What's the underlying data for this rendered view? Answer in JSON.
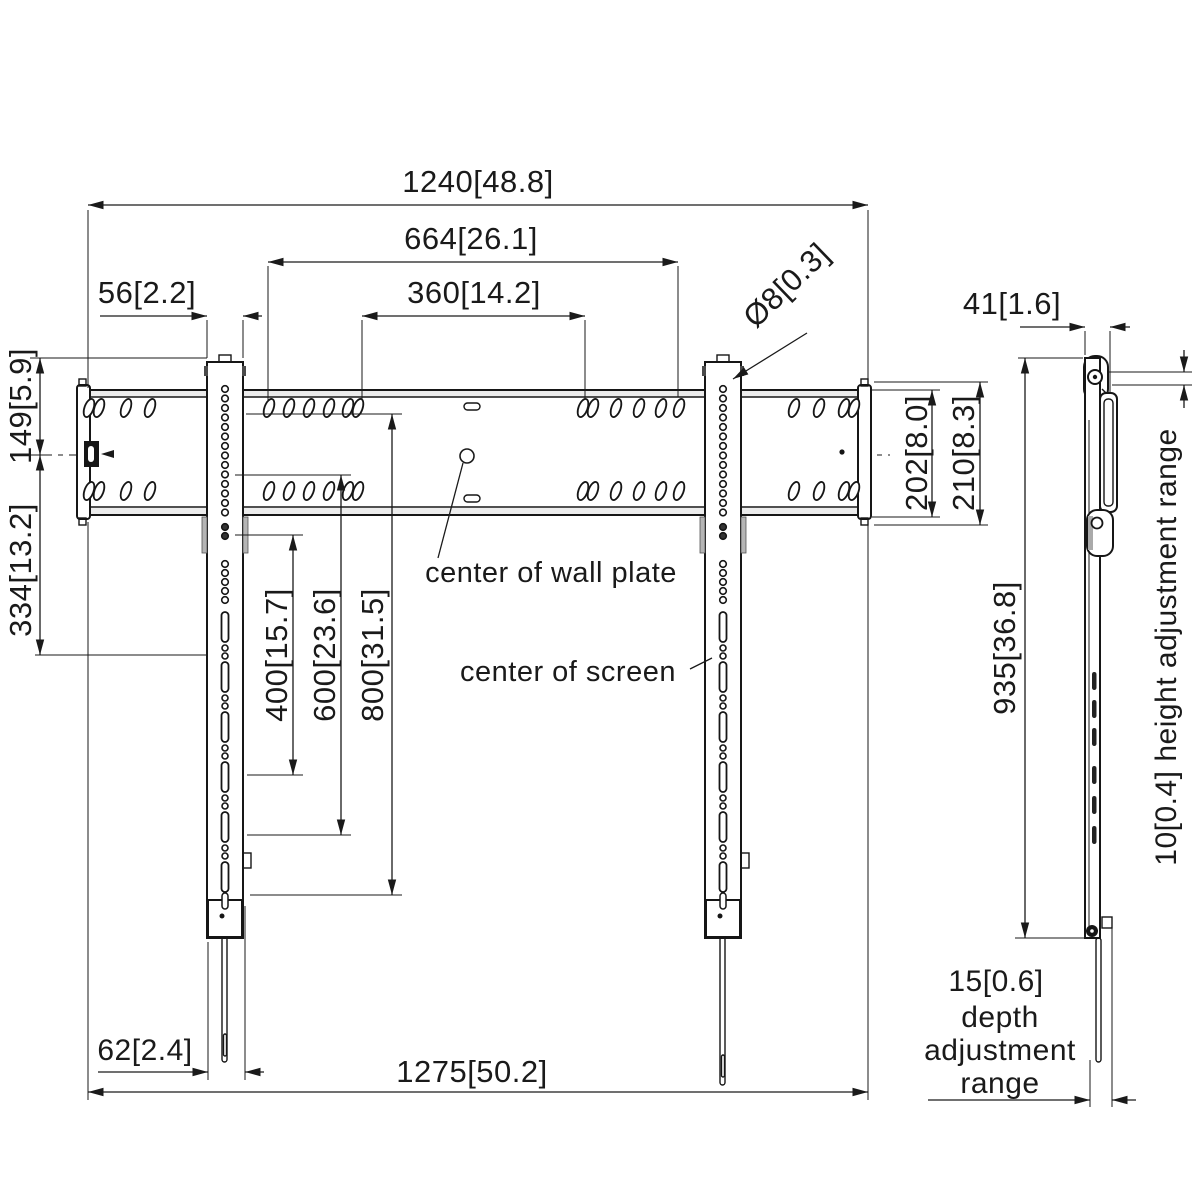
{
  "front_view": {
    "dims": {
      "wall_plate_width": "1240[48.8]",
      "outer_hole_span": "664[26.1]",
      "inner_hole_span": "360[14.2]",
      "rail_width": "56[2.2]",
      "hole_diameter": "Ø8[0.3]",
      "rail_top_to_plate_center": "149[5.9]",
      "plate_center_to_screen_center": "334[13.2]",
      "vesa_400": "400[15.7]",
      "vesa_600": "600[23.6]",
      "vesa_800": "800[31.5]",
      "plate_height": "202[8.0]",
      "plate_height_overall": "210[8.3]",
      "strap_width": "62[2.4]",
      "overall_width": "1275[50.2]"
    },
    "notes": {
      "center_of_wall_plate": "center of wall plate",
      "center_of_screen": "center of screen"
    }
  },
  "side_view": {
    "dims": {
      "depth": "41[1.6]",
      "height": "935[36.8]"
    },
    "notes": {
      "height_adjustment": "10[0.4] height adjustment range",
      "depth_adjustment_value": "15[0.6]",
      "depth_adjustment_word1": "depth",
      "depth_adjustment_word2": "adjustment",
      "depth_adjustment_word3": "range"
    }
  },
  "colors": {
    "line": "#1a1a1a",
    "gray_tab": "#b5b5b5",
    "background": "#ffffff"
  }
}
